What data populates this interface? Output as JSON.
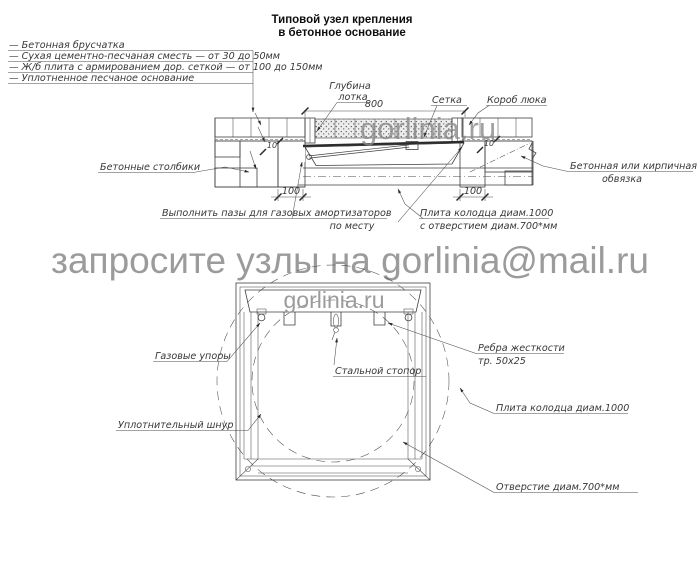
{
  "title": {
    "line1": "Типовой узел крепления",
    "line2": "в бетонное основание"
  },
  "legend": {
    "items": [
      "—  Бетонная брусчатка",
      "—  Сухая цементно-песчаная сместь — от 30 до 50мм",
      "—  Ж/б плита с армированием дор. сеткой — от 100 до 150мм",
      "—  Уплотненное песчаное основание"
    ]
  },
  "section": {
    "labels": {
      "depth_line1": "Глубина",
      "depth_line2": "лотка",
      "mesh": "Сетка",
      "hatch_box": "Короб люка",
      "posts": "Бетонные столбики",
      "edging_line1": "Бетонная или кирпичная",
      "edging_line2": "обвязка",
      "grooves_line1": "Выполнить пазы для газовых амортизаторов",
      "grooves_line2": "по месту",
      "plate_line1": "Плита колодца диам.1000",
      "plate_line2": "с отверстием диам.700*мм"
    },
    "dimensions": {
      "width": "800",
      "post_left": "100",
      "post_right": "100",
      "small_left": "10",
      "small_right": "10"
    }
  },
  "plan": {
    "labels": {
      "gas_stops": "Газовые упоры",
      "stopper": "Стальной стопор",
      "ribs_line1": "Ребра жесткости",
      "ribs_line2": "тр. 50х25",
      "plate": "Плита колодца диам.1000",
      "cord": "Уплотнительный шнур",
      "opening": "Отверстие диам.700*мм"
    }
  },
  "watermark": {
    "banner": "запросите узлы на gorlinia@mail.ru",
    "brand_section": "gorlinia.ru",
    "brand_plan": "gorlinia.ru"
  },
  "colors": {
    "line": "#3f3f3f",
    "watermark": "#9b9b9b",
    "watermark_dark": "#8a8a8a",
    "accent_magenta": "#d37bd0"
  }
}
